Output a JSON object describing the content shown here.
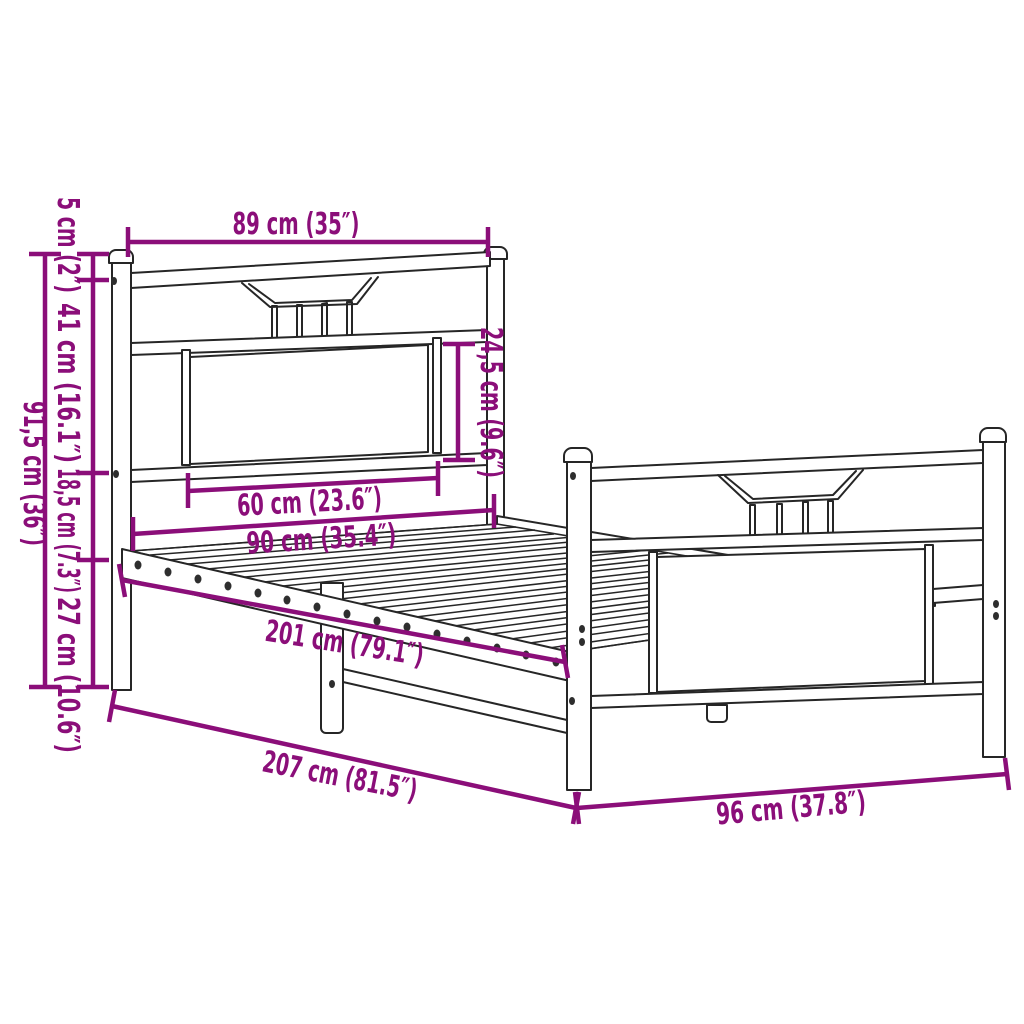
{
  "colors": {
    "dim": "#8B0E79",
    "ink": "#262626",
    "bg": "#FFFFFF"
  },
  "diagram_type": "bed-frame dimension drawing",
  "dims": {
    "head_width": "89 cm (35″)",
    "cap_height": "5 cm (2″)",
    "upper_height": "41 cm (16.1″)",
    "mid_height": "18,5 cm (7.3″)",
    "leg_height": "27 cm (10.6″)",
    "total_height": "91,5 cm (36″)",
    "panel_height": "24,5 cm (9.6″)",
    "panel_width": "60 cm (23.6″)",
    "inner_width": "90 cm (35.4″)",
    "inner_length": "201 cm (79.1″)",
    "total_length": "207 cm (81.5″)",
    "foot_width": "96 cm (37.8″)"
  }
}
